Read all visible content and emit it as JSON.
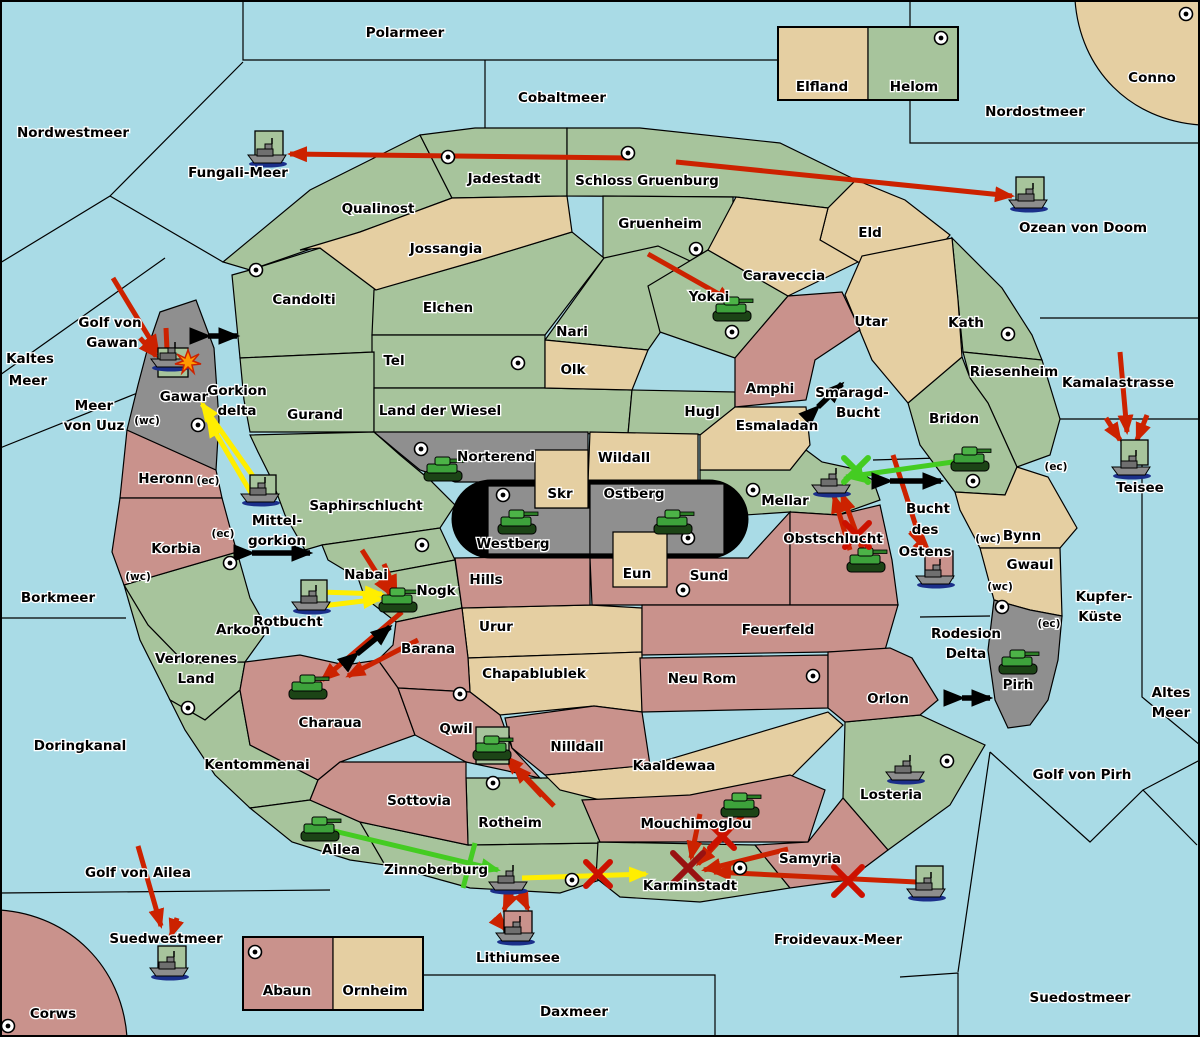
{
  "labels": {
    "polarmeer": "Polarmeer",
    "cobaltmeer": "Cobaltmeer",
    "nordwestmeer": "Nordwestmeer",
    "nordostmeer": "Nordostmeer",
    "conno": "Conno",
    "fungali_meer": "Fungali-Meer",
    "ozean_von_doom": "Ozean von Doom",
    "kamalastrasse": "Kamalastrasse",
    "teisee": "Teisee",
    "kaltes_1": "Kaltes",
    "kaltes_2": "Meer",
    "golf_gawan_1": "Golf von",
    "golf_gawan_2": "Gawan",
    "meer_uuz_1": "Meer",
    "meer_uuz_2": "von Uuz",
    "gorkion_1": "Gorkion",
    "gorkion_2": "delta",
    "mittelgorkion_1": "Mittel-",
    "mittelgorkion_2": "gorkion",
    "rotbucht": "Rotbucht",
    "borkmeer": "Borkmeer",
    "doringkanal": "Doringkanal",
    "golf_ailea": "Golf von Ailea",
    "suedwestmeer": "Suedwestmeer",
    "corws": "Corws",
    "daxmeer": "Daxmeer",
    "froidevaux": "Froidevaux-Meer",
    "suedostmeer": "Suedostmeer",
    "golf_pirh": "Golf von Pirh",
    "altes_1": "Altes",
    "altes_2": "Meer",
    "kupfer_1": "Kupfer-",
    "kupfer_2": "Küste",
    "smaragd_1": "Smaragd-",
    "smaragd_2": "Bucht",
    "ostens_1": "Bucht",
    "ostens_2": "des",
    "ostens_3": "Ostens",
    "rodesion_1": "Rodesion",
    "rodesion_2": "Delta",
    "lithiumsee": "Lithiumsee",
    "qualinost": "Qualinost",
    "jadestadt": "Jadestadt",
    "schloss_gruenburg": "Schloss Gruenburg",
    "gruenheim": "Gruenheim",
    "eld": "Eld",
    "caraveccia": "Caraveccia",
    "jossangia": "Jossangia",
    "candolti": "Candolti",
    "elchen": "Elchen",
    "yokai": "Yokai",
    "utar": "Utar",
    "kath": "Kath",
    "nari": "Nari",
    "tel": "Tel",
    "olk": "Olk",
    "riesenheim": "Riesenheim",
    "gurand": "Gurand",
    "land_der_wiesel": "Land der Wiesel",
    "hugl": "Hugl",
    "amphi": "Amphi",
    "esmaladan": "Esmaladan",
    "bridon": "Bridon",
    "norterend": "Norterend",
    "wildall": "Wildall",
    "skr": "Skr",
    "ostberg": "Ostberg",
    "mellar": "Mellar",
    "saphirschlucht": "Saphirschlucht",
    "westberg": "Westberg",
    "obstschlucht": "Obstschlucht",
    "bynn": "Bynn",
    "gwaul": "Gwaul",
    "heronn": "Heronn",
    "korbia": "Korbia",
    "gawar": "Gawar",
    "hills": "Hills",
    "eun": "Eun",
    "sund": "Sund",
    "nabai": "Nabai",
    "nogk": "Nogk",
    "urur": "Urur",
    "feuerfeld": "Feuerfeld",
    "arkoon": "Arkoon",
    "barana": "Barana",
    "verlorenes_1": "Verlorenes",
    "verlorenes_2": "Land",
    "chapablublek": "Chapablublek",
    "neu_rom": "Neu Rom",
    "orlon": "Orlon",
    "pirh": "Pirh",
    "charaua": "Charaua",
    "qwil": "Qwil",
    "nilldall": "Nilldall",
    "kaaldewaa": "Kaaldewaa",
    "kentommenai": "Kentommenai",
    "losteria": "Losteria",
    "sottovia": "Sottovia",
    "rotheim": "Rotheim",
    "ailea": "Ailea",
    "mouchimoglou": "Mouchimoglou",
    "zinnoberburg": "Zinnoberburg",
    "karminstadt": "Karminstadt",
    "samyria": "Samyria",
    "elfland": "Elfland",
    "helom": "Helom",
    "abaun": "Abaun",
    "ornheim": "Ornheim",
    "tag_wc1": "(wc)",
    "tag_ec1": "(ec)",
    "tag_ec2": "(ec)",
    "tag_wc2": "(wc)",
    "tag_ec3": "(ec)",
    "tag_wc3": "(wc)",
    "tag_wc4": "(wc)",
    "tag_ec4": "(ec)"
  },
  "map": {
    "colors": {
      "sea": "#a9dbe6",
      "land_green": "#a7c49c",
      "land_tan": "#e5cfa2",
      "land_red": "#c9928c",
      "land_gray": "#8f8f8f",
      "arrow_red": "#cc2200",
      "arrow_yellow": "#ffee00",
      "arrow_green": "#44cc22",
      "arrow_black": "#000000"
    },
    "city_dots": [
      [
        448,
        157
      ],
      [
        628,
        153
      ],
      [
        696,
        249
      ],
      [
        941,
        38
      ],
      [
        1186,
        14
      ],
      [
        256,
        270
      ],
      [
        518,
        363
      ],
      [
        198,
        425
      ],
      [
        421,
        449
      ],
      [
        503,
        495
      ],
      [
        688,
        538
      ],
      [
        732,
        332
      ],
      [
        753,
        490
      ],
      [
        1008,
        334
      ],
      [
        973,
        481
      ],
      [
        230,
        563
      ],
      [
        188,
        708
      ],
      [
        422,
        545
      ],
      [
        460,
        694
      ],
      [
        683,
        590
      ],
      [
        813,
        676
      ],
      [
        1002,
        607
      ],
      [
        947,
        761
      ],
      [
        8,
        1026
      ],
      [
        255,
        952
      ],
      [
        493,
        783
      ],
      [
        572,
        880
      ],
      [
        740,
        868
      ]
    ],
    "units": [
      {
        "t": "tank",
        "at": "norterend",
        "x": 443,
        "y": 470
      },
      {
        "t": "tank",
        "at": "westberg",
        "x": 517,
        "y": 523
      },
      {
        "t": "tank",
        "at": "ostberg",
        "x": 673,
        "y": 523
      },
      {
        "t": "tank",
        "at": "yokai",
        "x": 732,
        "y": 310
      },
      {
        "t": "tank",
        "at": "bridon",
        "x": 970,
        "y": 460
      },
      {
        "t": "tank",
        "at": "obstschlucht",
        "x": 866,
        "y": 561
      },
      {
        "t": "tank",
        "at": "nogk",
        "x": 398,
        "y": 601
      },
      {
        "t": "tank",
        "at": "charaua",
        "x": 308,
        "y": 688
      },
      {
        "t": "tank",
        "at": "qwil",
        "x": 492,
        "y": 749,
        "box": [
          476,
          727,
          33,
          37
        ],
        "bc": "gn"
      },
      {
        "t": "tank",
        "at": "pirh",
        "x": 1018,
        "y": 663
      },
      {
        "t": "tank",
        "at": "ailea",
        "x": 320,
        "y": 830
      },
      {
        "t": "tank",
        "at": "mouchimoglou",
        "x": 740,
        "y": 806
      },
      {
        "t": "ship",
        "at": "fungali-meer",
        "x": 269,
        "y": 153,
        "box": [
          255,
          131,
          28,
          29
        ],
        "bc": "gn"
      },
      {
        "t": "ship",
        "at": "ozean-von-doom",
        "x": 1030,
        "y": 198,
        "box": [
          1016,
          177,
          28,
          27
        ],
        "bc": "gn"
      },
      {
        "t": "ship",
        "at": "gawar",
        "x": 172,
        "y": 357,
        "box": [
          158,
          348,
          30,
          29
        ],
        "bc": "gn"
      },
      {
        "t": "ship",
        "at": "mittelgorkion",
        "x": 262,
        "y": 492,
        "box": [
          250,
          475,
          26,
          24
        ],
        "bc": "gn"
      },
      {
        "t": "ship",
        "at": "rotbucht",
        "x": 313,
        "y": 600,
        "box": [
          301,
          580,
          26,
          24
        ],
        "bc": "gn"
      },
      {
        "t": "ship",
        "at": "mellar",
        "x": 833,
        "y": 483
      },
      {
        "t": "ship",
        "at": "bucht-des-ostens",
        "x": 937,
        "y": 574,
        "box": [
          925,
          551,
          28,
          27
        ],
        "bc": "pk"
      },
      {
        "t": "ship",
        "at": "teisee",
        "x": 1133,
        "y": 465,
        "box": [
          1121,
          440,
          27,
          25
        ],
        "bc": "gn"
      },
      {
        "t": "ship",
        "at": "suedwestmeer",
        "x": 171,
        "y": 966,
        "box": [
          158,
          946,
          28,
          25
        ],
        "bc": "gn"
      },
      {
        "t": "ship",
        "at": "zinnoberburg",
        "x": 510,
        "y": 880
      },
      {
        "t": "ship",
        "at": "lithiumsee",
        "x": 517,
        "y": 931,
        "box": [
          504,
          911,
          28,
          25
        ],
        "bc": "pk"
      },
      {
        "t": "ship",
        "at": "froidevaux-meer",
        "x": 928,
        "y": 887,
        "box": [
          916,
          866,
          27,
          25
        ],
        "bc": "gn"
      },
      {
        "t": "ship",
        "at": "losteria",
        "x": 907,
        "y": 770
      }
    ],
    "arrows": [
      {
        "c": "red",
        "h": "end",
        "p": [
          [
            630,
            158
          ],
          [
            290,
            154
          ]
        ]
      },
      {
        "c": "red",
        "h": "end",
        "p": [
          [
            676,
            162
          ],
          [
            1012,
            196
          ]
        ]
      },
      {
        "c": "red",
        "h": "end",
        "p": [
          [
            648,
            254
          ],
          [
            733,
            302
          ]
        ]
      },
      {
        "c": "red",
        "h": "end",
        "p": [
          [
            113,
            278
          ],
          [
            158,
            352
          ]
        ]
      },
      {
        "c": "red",
        "h": "end",
        "p": [
          [
            140,
            338
          ],
          [
            156,
            356
          ]
        ]
      },
      {
        "c": "red",
        "h": "none",
        "p": [
          [
            166,
            328
          ],
          [
            167,
            350
          ]
        ]
      },
      {
        "c": "red",
        "h": "end",
        "p": [
          [
            362,
            550
          ],
          [
            390,
            594
          ]
        ]
      },
      {
        "c": "red",
        "h": "end",
        "p": [
          [
            384,
            564
          ],
          [
            396,
            592
          ]
        ]
      },
      {
        "c": "red",
        "h": "end",
        "p": [
          [
            402,
            612
          ],
          [
            322,
            680
          ]
        ]
      },
      {
        "c": "red",
        "h": "end",
        "p": [
          [
            418,
            640
          ],
          [
            348,
            676
          ]
        ]
      },
      {
        "c": "red",
        "h": "end",
        "p": [
          [
            554,
            806
          ],
          [
            506,
            757
          ]
        ]
      },
      {
        "c": "red",
        "h": "end",
        "p": [
          [
            542,
            796
          ],
          [
            514,
            766
          ]
        ]
      },
      {
        "c": "red",
        "h": "end",
        "p": [
          [
            864,
            554
          ],
          [
            842,
            494
          ]
        ]
      },
      {
        "c": "red",
        "h": "end",
        "p": [
          [
            850,
            550
          ],
          [
            834,
            496
          ]
        ]
      },
      {
        "c": "red",
        "h": "end",
        "p": [
          [
            893,
            455
          ],
          [
            922,
            545
          ]
        ]
      },
      {
        "c": "red",
        "h": "end",
        "p": [
          [
            910,
            532
          ],
          [
            930,
            553
          ]
        ]
      },
      {
        "c": "red",
        "h": "end",
        "p": [
          [
            1120,
            352
          ],
          [
            1127,
            432
          ]
        ]
      },
      {
        "c": "red",
        "h": "end",
        "p": [
          [
            1106,
            418
          ],
          [
            1120,
            440
          ]
        ]
      },
      {
        "c": "red",
        "h": "end",
        "p": [
          [
            1147,
            415
          ],
          [
            1137,
            440
          ]
        ]
      },
      {
        "c": "red",
        "h": "end",
        "p": [
          [
            138,
            846
          ],
          [
            161,
            926
          ]
        ]
      },
      {
        "c": "red",
        "h": "end",
        "p": [
          [
            177,
            918
          ],
          [
            171,
            936
          ]
        ]
      },
      {
        "c": "red",
        "h": "end",
        "p": [
          [
            512,
            892
          ],
          [
            504,
            910
          ]
        ]
      },
      {
        "c": "red",
        "h": "end",
        "p": [
          [
            520,
            892
          ],
          [
            528,
            909
          ]
        ]
      },
      {
        "c": "red",
        "h": "end",
        "p": [
          [
            498,
            921
          ],
          [
            506,
            930
          ]
        ]
      },
      {
        "c": "red",
        "h": "end",
        "p": [
          [
            916,
            882
          ],
          [
            714,
            872
          ]
        ]
      },
      {
        "c": "red",
        "h": "end",
        "p": [
          [
            700,
            814
          ],
          [
            691,
            858
          ]
        ]
      },
      {
        "c": "red",
        "h": "end",
        "p": [
          [
            746,
            812
          ],
          [
            698,
            864
          ]
        ]
      },
      {
        "c": "red",
        "h": "end",
        "p": [
          [
            788,
            849
          ],
          [
            704,
            870
          ]
        ]
      },
      {
        "c": "yellow",
        "h": "end",
        "p": [
          [
            260,
            486
          ],
          [
            202,
            404
          ]
        ]
      },
      {
        "c": "yellow",
        "h": "end",
        "p": [
          [
            254,
            498
          ],
          [
            208,
            420
          ]
        ]
      },
      {
        "c": "yellow",
        "h": "end",
        "p": [
          [
            320,
            592
          ],
          [
            382,
            594
          ]
        ]
      },
      {
        "c": "yellow",
        "h": "end",
        "p": [
          [
            322,
            606
          ],
          [
            380,
            599
          ]
        ]
      },
      {
        "c": "yellow",
        "h": "end",
        "p": [
          [
            522,
            878
          ],
          [
            646,
            874
          ]
        ]
      },
      {
        "c": "green",
        "h": "end",
        "p": [
          [
            960,
            461
          ],
          [
            846,
            477
          ]
        ]
      },
      {
        "c": "green",
        "h": "end",
        "p": [
          [
            334,
            831
          ],
          [
            498,
            870
          ]
        ]
      },
      {
        "c": "green",
        "h": "none",
        "p": [
          [
            475,
            843
          ],
          [
            463,
            888
          ]
        ]
      },
      {
        "c": "black",
        "h": "both",
        "p": [
          [
            208,
            336
          ],
          [
            237,
            336
          ]
        ]
      },
      {
        "c": "black",
        "h": "both",
        "p": [
          [
            252,
            553
          ],
          [
            310,
            553
          ]
        ]
      },
      {
        "c": "black",
        "h": "both",
        "p": [
          [
            357,
            654
          ],
          [
            390,
            627
          ]
        ]
      },
      {
        "c": "black",
        "h": "both",
        "p": [
          [
            818,
            407
          ],
          [
            842,
            384
          ]
        ]
      },
      {
        "c": "black",
        "h": "both",
        "p": [
          [
            890,
            481
          ],
          [
            941,
            481
          ]
        ]
      },
      {
        "c": "black",
        "h": "both",
        "p": [
          [
            962,
            698
          ],
          [
            990,
            698
          ]
        ]
      }
    ],
    "x_marks": [
      {
        "x": 598,
        "y": 874,
        "color": "#cc1100",
        "size": 12
      },
      {
        "x": 848,
        "y": 881,
        "color": "#cc1100",
        "size": 14
      },
      {
        "x": 722,
        "y": 836,
        "color": "#cc1100",
        "size": 12
      },
      {
        "x": 688,
        "y": 868,
        "color": "#991111",
        "size": 15
      },
      {
        "x": 857,
        "y": 535,
        "color": "#cc1100",
        "size": 12
      },
      {
        "x": 856,
        "y": 470,
        "color": "#44cc22",
        "size": 12
      }
    ],
    "explosion": {
      "x": 188,
      "y": 362
    }
  }
}
